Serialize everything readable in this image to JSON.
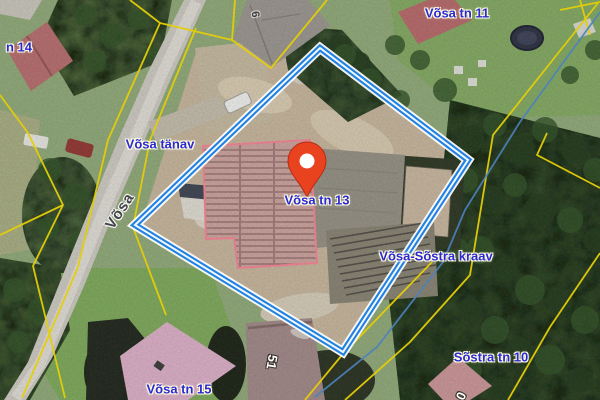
{
  "labels": {
    "tn14": "n 14",
    "vosa_tn_11": "Võsa tn 11",
    "vosa_tanav": "Võsa tänav",
    "vosa_street": "Võsa",
    "vosa_tn_13": "Võsa tn 13",
    "vosa_sostra_kraav": "Võsa-Sõstra kraav",
    "sostra_tn_10": "Sõstra tn 10",
    "vosa_tn_15": "Võsa tn 15",
    "building_9": "9",
    "building_51": "51",
    "building_partial": "0"
  },
  "colors": {
    "parcel_blue": "#2282e2",
    "cadastral_yellow": "#e4cd08",
    "stream_blue": "#4d82bc",
    "label_blue": "#2a2ad2",
    "street_label": "#44444c",
    "pin_red": "#e8421f"
  }
}
